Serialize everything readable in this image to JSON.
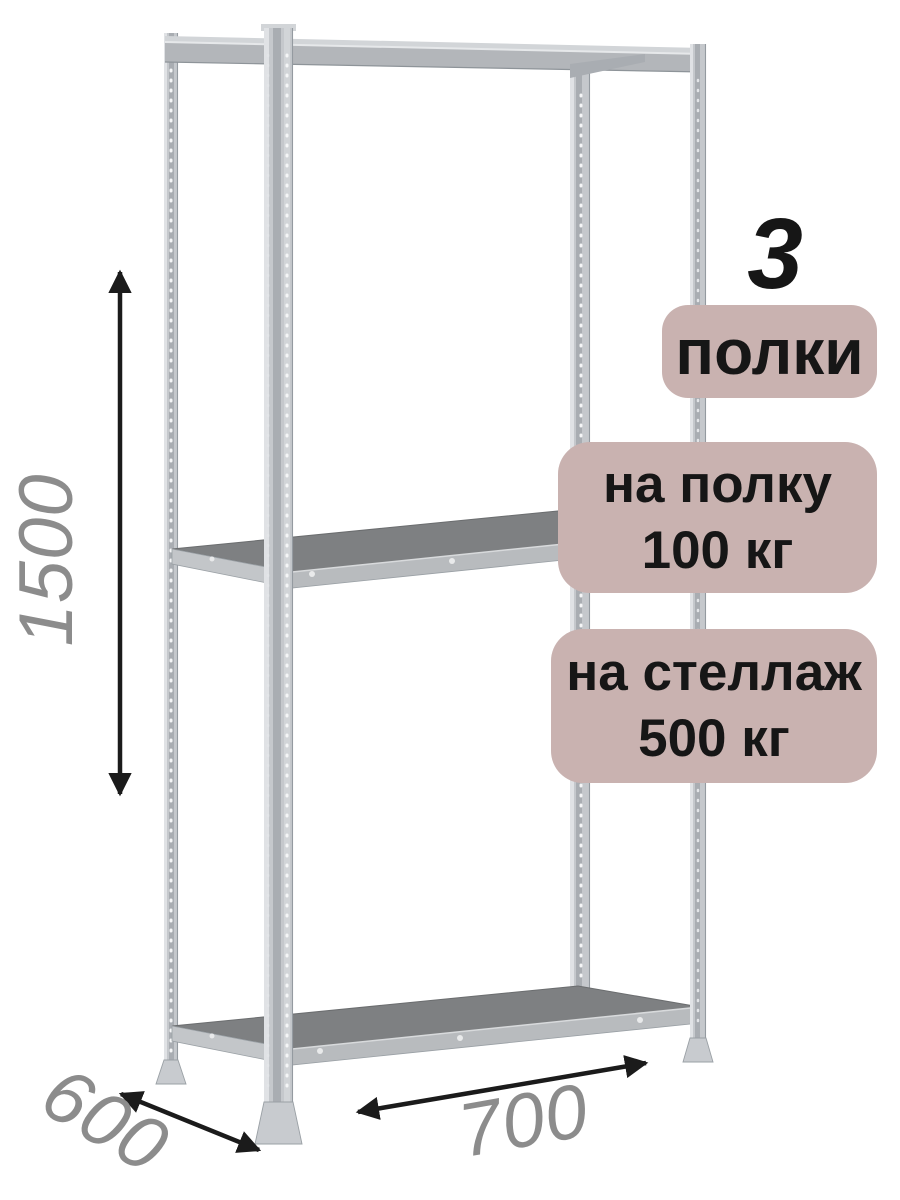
{
  "badges": {
    "shelf_count": {
      "number": "3",
      "label": "полки"
    },
    "per_shelf": {
      "line1": "на полку",
      "line2": "100 кг"
    },
    "per_rack": {
      "line1": "на стеллаж",
      "line2": "500 кг"
    }
  },
  "dimensions": {
    "height_mm": "1500",
    "depth_mm": "600",
    "width_mm": "700"
  },
  "colors": {
    "badge_bg": "#c9b2b0",
    "badge_text": "#161616",
    "dimension_text": "#8c8c8c",
    "arrow": "#1b1b1b",
    "metal_light": "#c5c8cc",
    "metal_mid": "#b3b6ba",
    "shelf_surface": "#7e8082",
    "background": "#ffffff"
  }
}
